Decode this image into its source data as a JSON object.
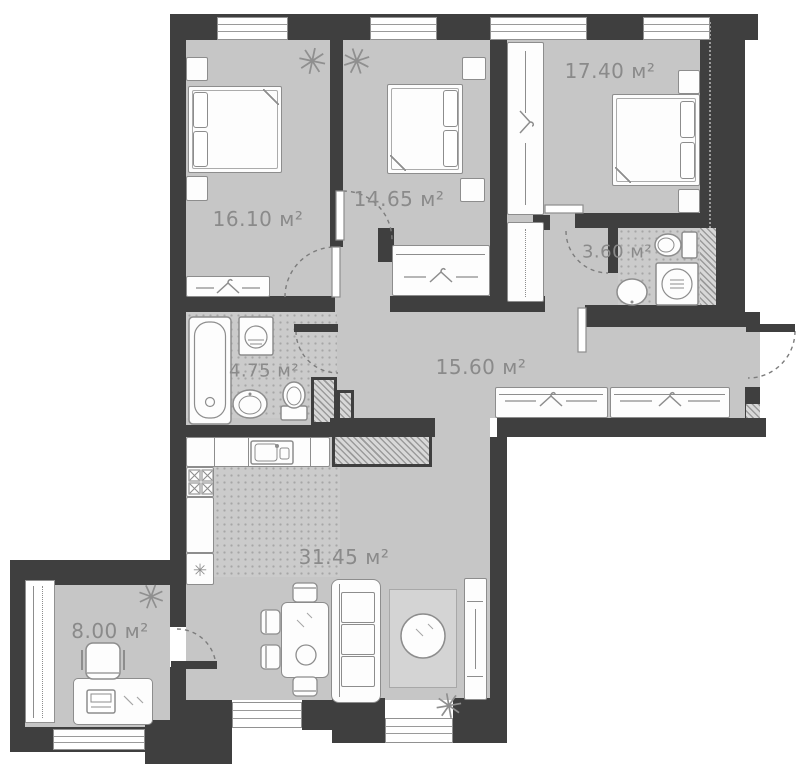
{
  "plan": {
    "type": "apartment-floor-plan",
    "unit": "м²",
    "rooms": [
      {
        "name": "bedroom-1",
        "label": "16.10 м²"
      },
      {
        "name": "bedroom-2",
        "label": "14.65 м²"
      },
      {
        "name": "bedroom-3",
        "label": "17.40 м²"
      },
      {
        "name": "bathroom-small",
        "label": "3.60 м²"
      },
      {
        "name": "bathroom-main",
        "label": "4.75 м²"
      },
      {
        "name": "hallway",
        "label": "15.60 м²"
      },
      {
        "name": "kitchen-living",
        "label": "31.45 м²"
      },
      {
        "name": "balcony-office",
        "label": "8.00 м²"
      }
    ],
    "colors": {
      "wall": "#3f3f3f",
      "floor": "#c6c6c6",
      "tiled_floor": "#cbcbcb",
      "furniture_outline": "#8d8d8d",
      "label_text": "#8a8a8a",
      "background": "#ffffff"
    }
  }
}
